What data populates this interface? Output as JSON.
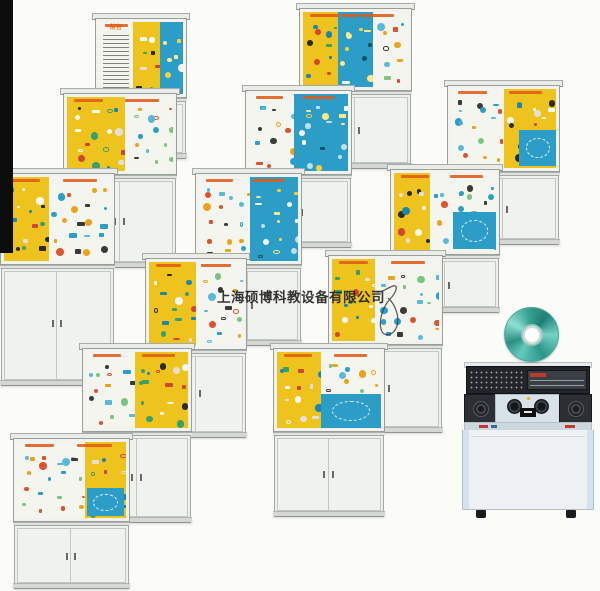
{
  "page": {
    "background": "#fbfbf8",
    "width": 600,
    "height": 591
  },
  "left_bar": {
    "x": 0,
    "y": 0,
    "w": 13,
    "h": 253,
    "color": "#0d0d0d"
  },
  "watermark": {
    "text": "上海硕博科教设备有限公司",
    "x": 217,
    "y": 286,
    "font_size": 13.5,
    "color": "rgba(35,35,35,0.92)"
  },
  "text_board": {
    "title": "前言"
  },
  "panel_colors": {
    "yellow": "#eec31d",
    "blue": "#2b9dc6",
    "white": "#f5f5f0"
  },
  "strip_color": "#e05a17",
  "palettes": {
    "yellow": [
      "#cf4631",
      "#1d86b0",
      "#2b2b2b",
      "#f7f7f3",
      "#38a06c",
      "#e5e0d2"
    ],
    "blue": [
      "#f2d23c",
      "#f7f7f3",
      "#ffe789",
      "#bfe0ea",
      "#1b4f63"
    ],
    "white": [
      "#2e9ec7",
      "#d9542f",
      "#e8a51c",
      "#3a3a3a",
      "#58b9d9",
      "#7cc47f"
    ]
  },
  "cabinets": [
    {
      "id": "c1",
      "x": 95,
      "y": 13,
      "w": 92,
      "dh": 80,
      "ch": 58,
      "seed": 11,
      "strips": 1,
      "panels": [
        {
          "k": "white",
          "f": 0.4,
          "text_board": true
        },
        {
          "k": "yellow",
          "f": 0.33
        },
        {
          "k": "blue",
          "f": 0.27
        }
      ]
    },
    {
      "id": "c2",
      "x": 299,
      "y": 3,
      "w": 113,
      "dh": 83,
      "ch": 75,
      "seed": 22,
      "strips": 3,
      "panels": [
        {
          "k": "yellow",
          "f": 0.33
        },
        {
          "k": "blue",
          "f": 0.34
        },
        {
          "k": "white",
          "f": 0.33
        }
      ]
    },
    {
      "id": "c3",
      "x": 63,
      "y": 88,
      "w": 114,
      "dh": 82,
      "ch": 90,
      "seed": 33,
      "strips": 2,
      "panels": [
        {
          "k": "yellow",
          "f": 0.55
        },
        {
          "k": "white",
          "f": 0.45
        }
      ]
    },
    {
      "id": "c4",
      "x": 245,
      "y": 85,
      "w": 107,
      "dh": 85,
      "ch": 70,
      "seed": 44,
      "strips": 2,
      "panels": [
        {
          "k": "white",
          "f": 0.45
        },
        {
          "k": "blue",
          "f": 0.55
        }
      ]
    },
    {
      "id": "c5",
      "x": 447,
      "y": 80,
      "w": 113,
      "dh": 87,
      "ch": 70,
      "seed": 55,
      "strips": 2,
      "panels": [
        {
          "k": "white",
          "f": 0.5
        },
        {
          "k": "yellow",
          "f": 0.5
        }
      ],
      "sub": {
        "p": 1,
        "k": "blue",
        "l": 0.3,
        "t": 0.52,
        "w": 0.7,
        "h": 0.45
      }
    },
    {
      "id": "c6",
      "x": 0,
      "y": 168,
      "w": 115,
      "dh": 92,
      "ch": 118,
      "seed": 66,
      "strips": 2,
      "panels": [
        {
          "k": "yellow",
          "f": 0.42
        },
        {
          "k": "white",
          "f": 0.58
        }
      ]
    },
    {
      "id": "c7",
      "x": 195,
      "y": 168,
      "w": 107,
      "dh": 92,
      "ch": 78,
      "seed": 77,
      "strips": 2,
      "panels": [
        {
          "k": "white",
          "f": 0.52
        },
        {
          "k": "blue",
          "f": 0.48
        }
      ]
    },
    {
      "id": "c8",
      "x": 390,
      "y": 164,
      "w": 110,
      "dh": 86,
      "ch": 55,
      "seed": 88,
      "strips": 2,
      "panels": [
        {
          "k": "yellow",
          "f": 0.35
        },
        {
          "k": "white",
          "f": 0.65
        }
      ],
      "sub": {
        "p": 1,
        "k": "blue",
        "l": 0.35,
        "t": 0.5,
        "w": 0.65,
        "h": 0.48
      }
    },
    {
      "id": "c9",
      "x": 145,
      "y": 253,
      "w": 102,
      "dh": 92,
      "ch": 85,
      "seed": 99,
      "strips": 2,
      "panels": [
        {
          "k": "yellow",
          "f": 0.5
        },
        {
          "k": "white",
          "f": 0.5
        }
      ]
    },
    {
      "id": "c10",
      "x": 328,
      "y": 250,
      "w": 115,
      "dh": 90,
      "ch": 85,
      "seed": 110,
      "strips": 2,
      "panels": [
        {
          "k": "yellow",
          "f": 0.4
        },
        {
          "k": "white",
          "f": 0.6
        }
      ]
    },
    {
      "id": "c11",
      "x": 82,
      "y": 343,
      "w": 110,
      "dh": 84,
      "ch": 88,
      "seed": 121,
      "strips": 2,
      "panels": [
        {
          "k": "white",
          "f": 0.48
        },
        {
          "k": "yellow",
          "f": 0.52
        }
      ]
    },
    {
      "id": "c12",
      "x": 273,
      "y": 343,
      "w": 112,
      "dh": 84,
      "ch": 82,
      "seed": 132,
      "strips": 2,
      "panels": [
        {
          "k": "yellow",
          "f": 0.42
        },
        {
          "k": "white",
          "f": 0.58
        }
      ],
      "sub": {
        "p": 1,
        "k": "blue",
        "l": 0.0,
        "t": 0.55,
        "w": 1.0,
        "h": 0.45
      }
    },
    {
      "id": "c13",
      "x": 13,
      "y": 433,
      "w": 117,
      "dh": 84,
      "ch": 64,
      "seed": 143,
      "strips": 2,
      "panels": [
        {
          "k": "white",
          "f": 0.62
        },
        {
          "k": "yellow",
          "f": 0.38
        }
      ],
      "sub": {
        "p": 1,
        "k": "blue",
        "l": 0.05,
        "t": 0.6,
        "w": 0.9,
        "h": 0.38
      }
    }
  ],
  "cd": {
    "x": 504,
    "y": 307,
    "d": 53,
    "colors": [
      "#63cabd",
      "#2c8f84",
      "#8fdfd2",
      "#37a394",
      "#1f7d74",
      "#74d2c4",
      "#2c9488"
    ]
  },
  "console": {
    "x": 462,
    "y": 362,
    "w": 132,
    "h": 156,
    "accent_red": "#c0392e",
    "led_yellow": "#e2b01e",
    "rack_color": "#22252a",
    "body_color": "#eef1f3",
    "desk_color": "#d8e3e9"
  }
}
